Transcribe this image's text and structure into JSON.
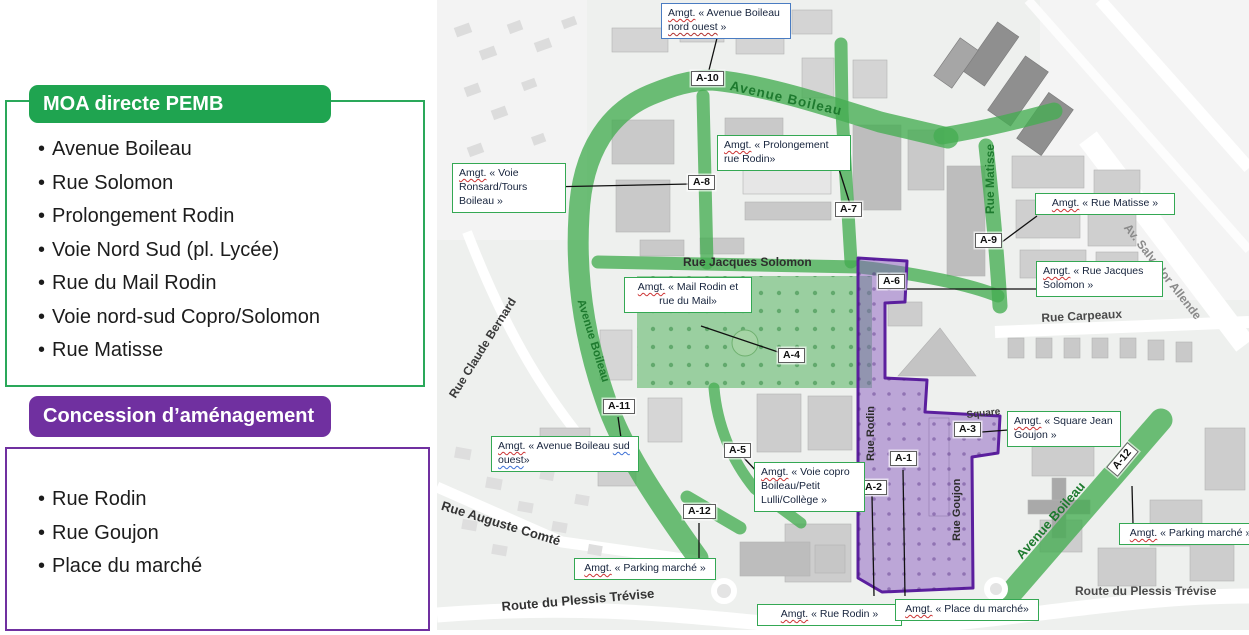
{
  "legend": {
    "moa": {
      "title": "MOA directe PEMB",
      "items": [
        "Avenue Boileau",
        "Rue Solomon",
        "Prolongement Rodin",
        "Voie Nord Sud (pl. Lycée)",
        "Rue du Mail Rodin",
        "Voie nord-sud Copro/Solomon",
        "Rue Matisse"
      ]
    },
    "concession": {
      "title": "Concession d’aménagement",
      "items": [
        "Rue Rodin",
        "Rue Goujon",
        "Place du marché"
      ]
    }
  },
  "map": {
    "streets": {
      "avenue_boileau_top": "Avenue Boileau",
      "avenue_boileau_left": "Avenue Boileau",
      "avenue_boileau_bottom": "Avenue Boileau",
      "rue_matisse": "Rue Matisse",
      "rue_jacques_solomon": "Rue Jacques Solomon",
      "rue_carpeaux": "Rue Carpeaux",
      "av_salvador_allende": "Av. Salvador Allende",
      "rue_claude_bernard": "Rue Claude Bernard",
      "rue_rodin": "Rue Rodin",
      "rue_goujon": "Rue Goujon",
      "square": "Square",
      "route_plessis_left": "Route du Plessis Trévise",
      "route_plessis_right": "Route du Plessis Trévise",
      "rue_auguste_comte": "Rue Auguste Comté"
    },
    "markers": {
      "a1": "A-1",
      "a2": "A-2",
      "a3": "A-3",
      "a4": "A-4",
      "a5": "A-5",
      "a6": "A-6",
      "a7": "A-7",
      "a8": "A-8",
      "a9": "A-9",
      "a10": "A-10",
      "a11": "A-11",
      "a12": "A-12"
    },
    "annotations": {
      "nord_ouest": {
        "amgt": "Amgt.",
        "body": " « Avenue Boileau ",
        "marked": "nord ouest",
        "tail": " »"
      },
      "ronsard": {
        "amgt": "Amgt.",
        "body": " « Voie Ronsard/Tours Boileau »"
      },
      "prolongement": {
        "amgt": "Amgt.",
        "body": " « Prolongement rue Rodin»"
      },
      "matisse": {
        "amgt": "Amgt.",
        "body": " « Rue Matisse »"
      },
      "solomon": {
        "amgt": "Amgt.",
        "body": " « Rue Jacques Solomon »"
      },
      "mail": {
        "amgt": "Amgt.",
        "body": " « Mail Rodin et rue du Mail»"
      },
      "sud_ouest": {
        "amgt": "Amgt.",
        "body": " « Avenue Boileau ",
        "marked": "sud ouest",
        "tail": "»"
      },
      "voie_copro": {
        "amgt": "Amgt.",
        "body": " « Voie copro Boileau/Petit Lulli/Collège »"
      },
      "square_jean_goujon": {
        "amgt": "Amgt.",
        "body": " « Square Jean Goujon »"
      },
      "parking_left": {
        "amgt": "Amgt.",
        "body": " « Parking marché »"
      },
      "parking_right": {
        "amgt": "Amgt.",
        "body": " « Parking marché »"
      },
      "rue_rodin": {
        "amgt": "Amgt.",
        "body": " « Rue Rodin »"
      },
      "place_marche": {
        "amgt": "Amgt.",
        "body": " « Place du marché»"
      }
    },
    "colors": {
      "moa_green": "#1fa450",
      "concession_purple": "#7030a0",
      "road_green": "#45ad52",
      "zone_purple_fill": "#8a5cc0",
      "zone_purple_stroke": "#5b1f9e",
      "street_text_green": "#1d7a2e",
      "annotation_border_green": "#34a853",
      "annotation_border_blue": "#4a7cc2"
    }
  }
}
